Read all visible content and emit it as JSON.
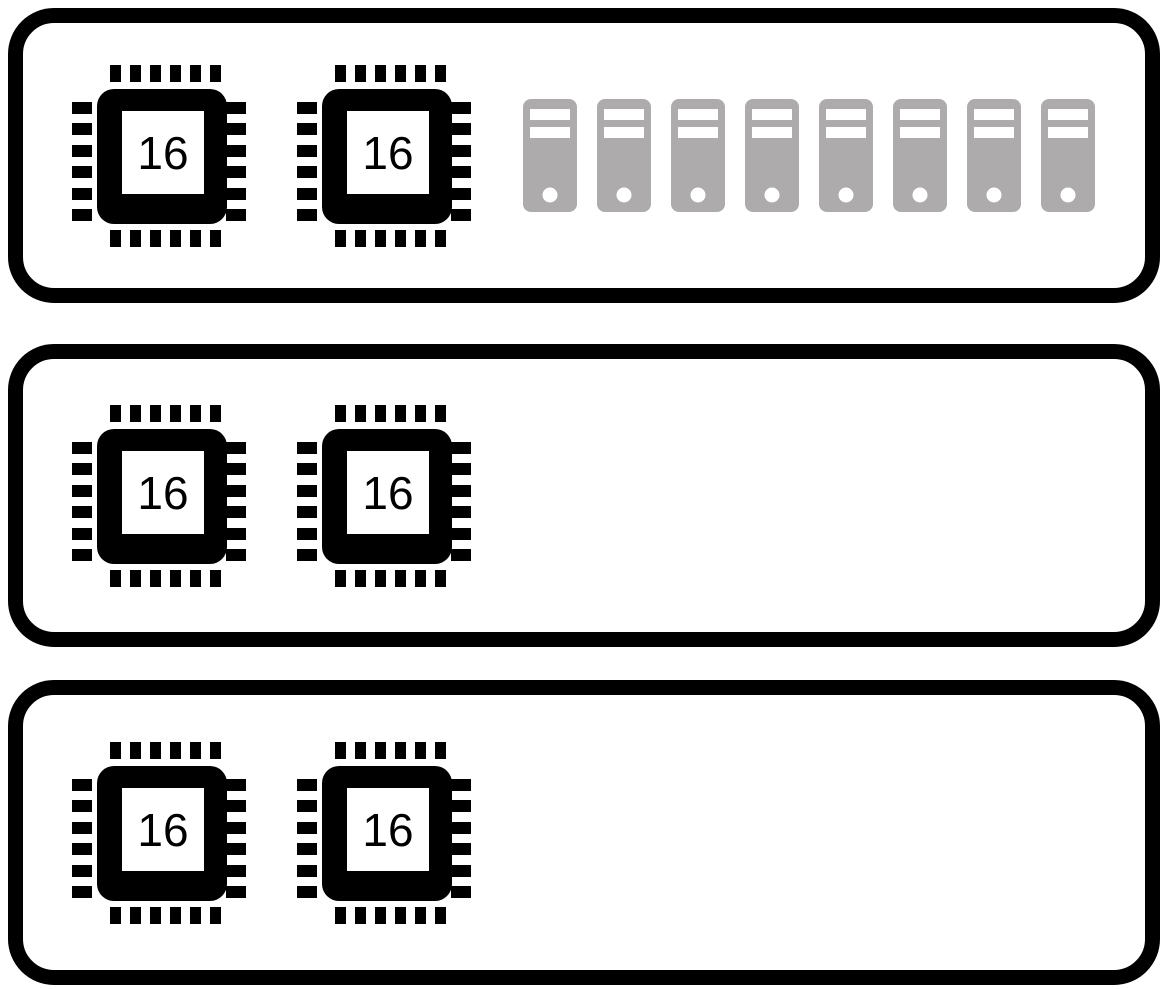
{
  "diagram": {
    "description_label": "",
    "colors": {
      "outline": "#000000",
      "node_background": "#ffffff",
      "server_fill": "#aeabac",
      "server_detail": "#ffffff",
      "cpu_fill": "#000000",
      "cpu_die_background": "#ffffff"
    },
    "icons": {
      "cpu": "cpu-chip-icon",
      "server": "server-tower-icon"
    },
    "nodes": [
      {
        "name": "node-1",
        "cpus": [
          {
            "cores": "16"
          },
          {
            "cores": "16"
          }
        ],
        "cpu_count": 2,
        "server_count": 8
      },
      {
        "name": "node-2",
        "cpus": [
          {
            "cores": "16"
          },
          {
            "cores": "16"
          }
        ],
        "cpu_count": 2,
        "server_count": 0
      },
      {
        "name": "node-3",
        "cpus": [
          {
            "cores": "16"
          },
          {
            "cores": "16"
          }
        ],
        "cpu_count": 2,
        "server_count": 0
      }
    ]
  }
}
